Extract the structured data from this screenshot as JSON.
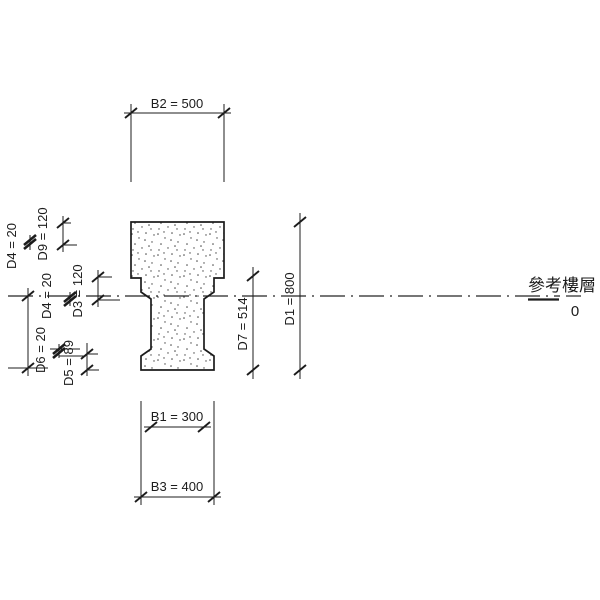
{
  "canvas": {
    "width": 600,
    "height": 600,
    "background": "#ffffff",
    "line_color": "#1c1c1c"
  },
  "section": {
    "material": "concrete-stipple"
  },
  "dims": {
    "b2": {
      "label": "B2 = 500"
    },
    "b1": {
      "label": "B1 = 300"
    },
    "b3": {
      "label": "B3 = 400"
    },
    "d1": {
      "label": "D1 = 800"
    },
    "d7": {
      "label": "D7 = 514"
    },
    "d4_top": {
      "label": "D4 = 20"
    },
    "d9": {
      "label": "D9 = 120"
    },
    "d4_mid": {
      "label": "D4 = 20"
    },
    "d3": {
      "label": "D3 = 120"
    },
    "d6": {
      "label": "D6 = 20"
    },
    "d5": {
      "label": "D5 = 89"
    },
    "left_clipped": {
      "label": "D2 = 400"
    }
  },
  "level": {
    "name": "參考樓層",
    "elevation": "0"
  }
}
